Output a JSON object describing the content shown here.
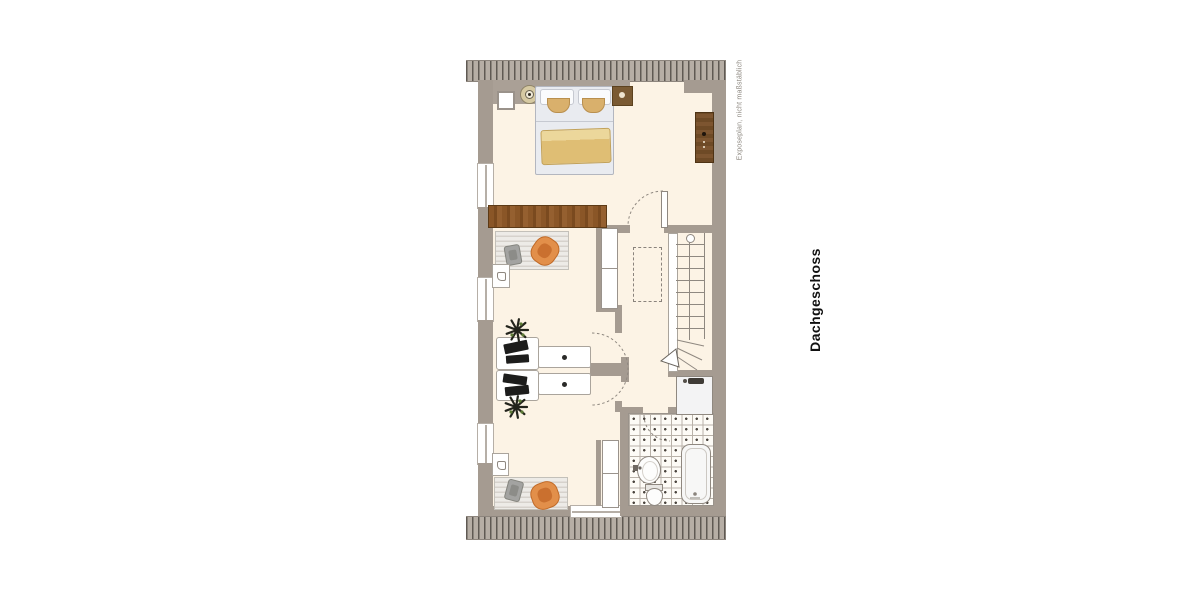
{
  "annotations": {
    "floor_label": "Dachgeschoss",
    "disclaimer": "Exposeplan, nicht maßstäblich"
  },
  "colors": {
    "background": "#ffffff",
    "exterior_wall": "#a59b91",
    "roof_hatch_line": "#5f5953",
    "interior_floor": "#fcf3e5",
    "wood_furniture": "#84522a",
    "accent_armchair_orange": "#e28f4a",
    "fixture_outline": "#8f8880",
    "label_text": "#111111",
    "note_text": "#8b867e"
  },
  "icons": {
    "lamp": "circle-with-center-dot",
    "shower_head": "dark-bar-with-knob",
    "drawer_knob": "black-dot",
    "stair_direction_arrow": "triangle",
    "plant": "radiating-star",
    "door_swing": "dashed-arc"
  }
}
